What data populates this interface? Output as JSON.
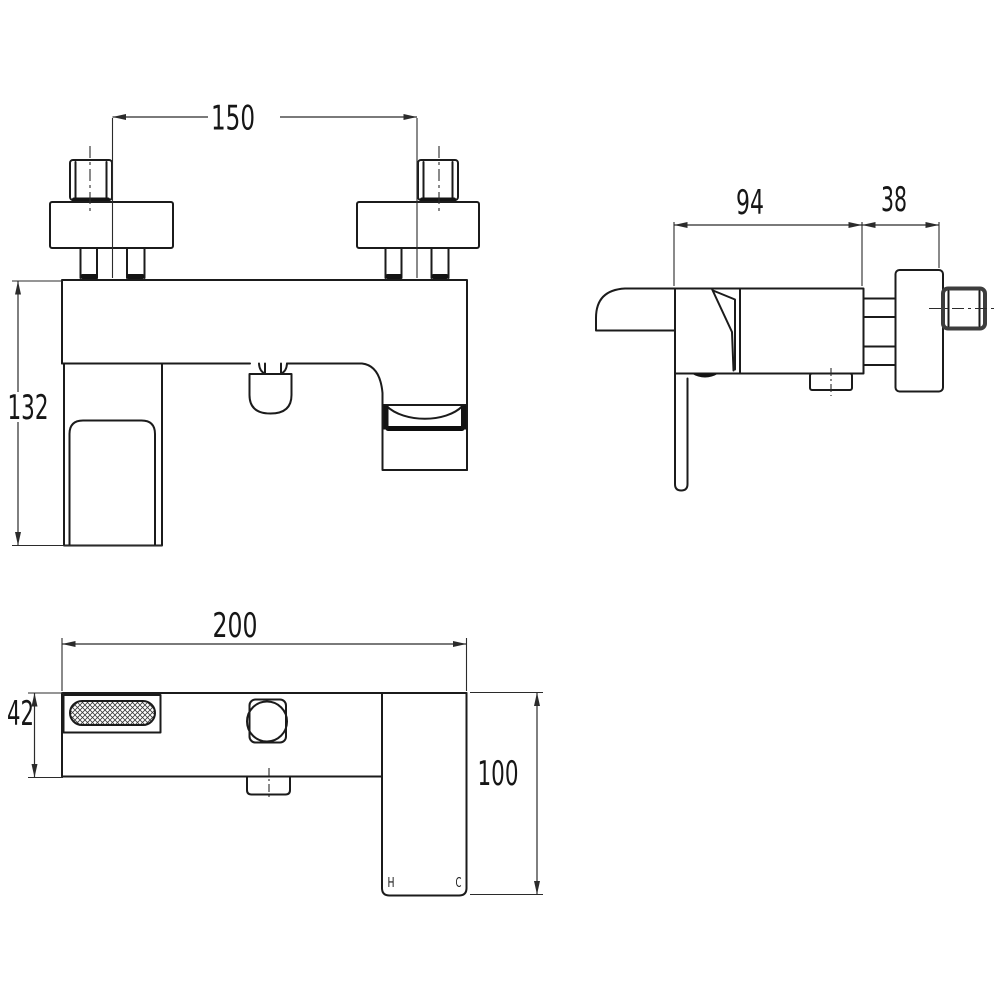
{
  "drawing": {
    "type": "technical-dimension-drawing",
    "subject": "wall-mounted bath shower mixer tap, three orthographic views",
    "dimensions": {
      "front_view": {
        "inlet_centres": "150",
        "overall_height": "132"
      },
      "side_view": {
        "body_projection": "94",
        "wall_connector": "38"
      },
      "bottom_view": {
        "overall_width": "200",
        "body_depth": "42",
        "handle_depth": "100"
      }
    },
    "labels": {
      "hot": "H",
      "cold": "C"
    },
    "colors": {
      "line": "#1b1b1b",
      "dimension": "#2b2b2b",
      "background": "#ffffff"
    }
  }
}
